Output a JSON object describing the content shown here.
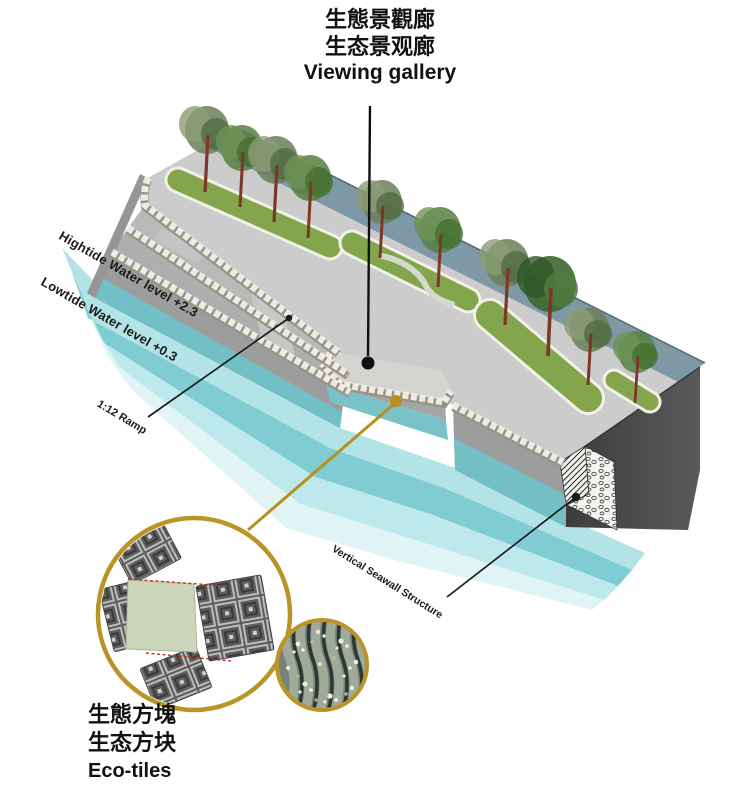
{
  "title": {
    "line1_traditional": "生態景觀廊",
    "line2_simplified": "生态景观廊",
    "line3_english": "Viewing gallery"
  },
  "annotations": {
    "hightide": "Hightide Water level +2.3",
    "lowtide": "Lowtide Water level +0.3",
    "ramp": "1:12 Ramp",
    "seawall": "Vertical Seawall Structure"
  },
  "eco_tiles": {
    "line1_traditional": "生態方塊",
    "line2_simplified": "生态方块",
    "line3_english": "Eco-tiles"
  },
  "colors": {
    "accent_gold": "#b7901f",
    "water_hightide_band": "#b2e3e6",
    "water_lowtide_band": "#7fccd3",
    "intertidal_wall_teal": "#72c0c6",
    "lawn_green": "#83a64d",
    "back_strip_slate": "#7e98a5",
    "stone_parapet": "#edebe2",
    "seawall_end_face": "#454545",
    "red_dashed": "#cd2a24"
  }
}
